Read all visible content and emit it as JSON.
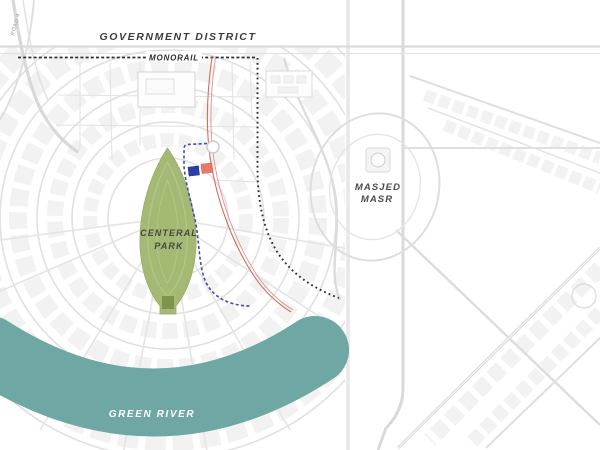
{
  "map": {
    "title": "city masterplan map",
    "labels": {
      "government_district": "GOVERNMENT DISTRICT",
      "monorail": "MONORAIL",
      "central_park_line1": "CENTERAL",
      "central_park_line2": "PARK",
      "masjed_line1": "MASJED",
      "masjed_line2": "MASR",
      "green_river": "GREEN RIVER",
      "road_left": "ROAD 4"
    },
    "colors": {
      "park_green": "#a4ba74",
      "park_edge": "#97ad64",
      "stem_olive": "#7f934f",
      "river_teal": "#6ea7a4",
      "monorail_black": "#2f2f2f",
      "boundary_blue": "#3c4cbb",
      "route_red": "#cc6f60",
      "plot_blue": "#2c3da8",
      "plot_salmon": "#e87a63",
      "road_gray": "#d9d9d9",
      "label_gray": "#3d3d3d"
    },
    "markers": [
      {
        "name": "plot-marker-blue",
        "color": "#2c3da8"
      },
      {
        "name": "plot-marker-salmon",
        "color": "#e87a63"
      }
    ]
  }
}
